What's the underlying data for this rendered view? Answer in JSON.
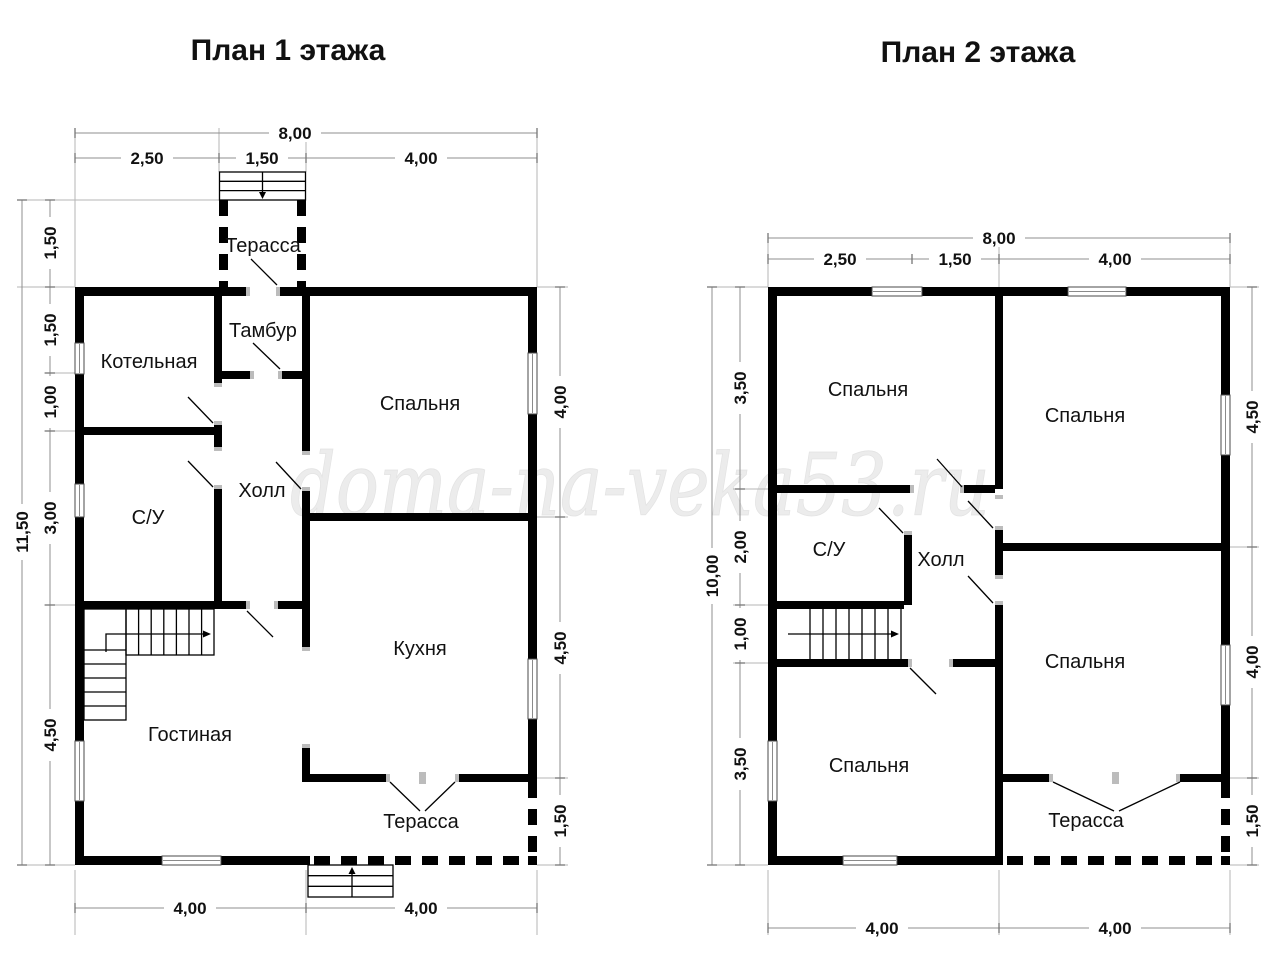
{
  "watermark": {
    "text": "doma-na-veka53.ru"
  },
  "floor1": {
    "title": "План 1 этажа",
    "rooms": {
      "terrace_top": "Терасса",
      "tambour": "Тамбур",
      "boiler_room": "Котельная",
      "bedroom": "Спальня",
      "hall": "Холл",
      "bathroom": "С/У",
      "kitchen": "Кухня",
      "living_room": "Гостиная",
      "terrace_bottom": "Терасса"
    },
    "dims": {
      "top_total": "8,00",
      "top": [
        "2,50",
        "1,50",
        "4,00"
      ],
      "left_total": "11,50",
      "left": [
        "1,50",
        "1,50",
        "1,00",
        "3,00",
        "4,50"
      ],
      "right": [
        "4,00",
        "4,50",
        "1,50"
      ],
      "bottom": [
        "4,00",
        "4,00"
      ]
    }
  },
  "floor2": {
    "title": "План 2 этажа",
    "rooms": {
      "bedroom_top_left": "Спальня",
      "bedroom_top_right": "Спальня",
      "bathroom": "С/У",
      "hall": "Холл",
      "bedroom_bottom_left": "Спальня",
      "bedroom_bottom_right": "Спальня",
      "terrace": "Терасса"
    },
    "dims": {
      "top_total": "8,00",
      "top": [
        "2,50",
        "1,50",
        "4,00"
      ],
      "left_total": "10,00",
      "left": [
        "3,50",
        "2,00",
        "1,00",
        "3,50"
      ],
      "right": [
        "4,50",
        "4,00",
        "1,50"
      ],
      "bottom": [
        "4,00",
        "4,00"
      ]
    }
  },
  "colors": {
    "wall": "#000000",
    "dim_line": "#8f8f8f",
    "extension_line": "#b5b5b5",
    "text": "#111111",
    "watermark": "#ececec"
  }
}
